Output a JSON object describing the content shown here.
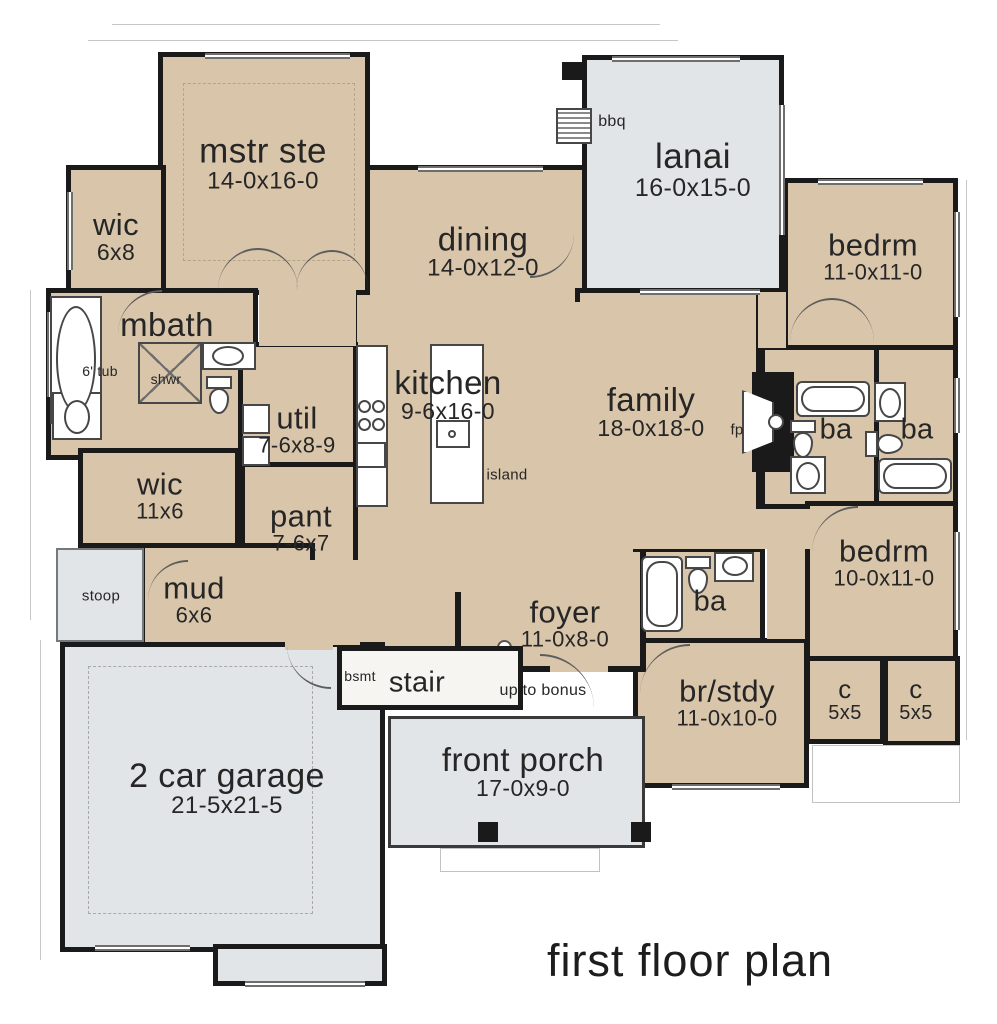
{
  "title": "first floor plan",
  "colors": {
    "floor": "#d8c5aa",
    "outdoor": "#e2e5e7",
    "wall": "#1a1a1a"
  },
  "rooms": [
    {
      "label": "mstr ste",
      "dims": "14-0x16-0"
    },
    {
      "label": "wic",
      "dims": "6x8"
    },
    {
      "label": "mbath",
      "dims": ""
    },
    {
      "label": "dining",
      "dims": "14-0x12-0"
    },
    {
      "label": "lanai",
      "dims": "16-0x15-0"
    },
    {
      "label": "bedrm",
      "dims": "11-0x11-0"
    },
    {
      "label": "kitchen",
      "dims": "9-6x16-0"
    },
    {
      "label": "family",
      "dims": "18-0x18-0"
    },
    {
      "label": "util",
      "dims": "7-6x8-9"
    },
    {
      "label": "wic",
      "dims": "11x6"
    },
    {
      "label": "pant",
      "dims": "7-6x7"
    },
    {
      "label": "mud",
      "dims": "6x6"
    },
    {
      "label": "stoop",
      "dims": ""
    },
    {
      "label": "2 car garage",
      "dims": "21-5x21-5"
    },
    {
      "label": "foyer",
      "dims": "11-0x8-0"
    },
    {
      "label": "stair",
      "dims": ""
    },
    {
      "label": "ba",
      "dims": ""
    },
    {
      "label": "ba",
      "dims": ""
    },
    {
      "label": "bedrm",
      "dims": "10-0x11-0"
    },
    {
      "label": "ba",
      "dims": ""
    },
    {
      "label": "br/stdy",
      "dims": "11-0x10-0"
    },
    {
      "label": "c",
      "dims": "5x5"
    },
    {
      "label": "c",
      "dims": "5x5"
    },
    {
      "label": "front porch",
      "dims": "17-0x9-0"
    }
  ],
  "annotations": {
    "bbq": "bbq",
    "tub": "6' tub",
    "shwr": "shwr",
    "island": "island",
    "fp": "fp",
    "bsmt": "bsmt",
    "up_to_bonus": "up to bonus"
  }
}
